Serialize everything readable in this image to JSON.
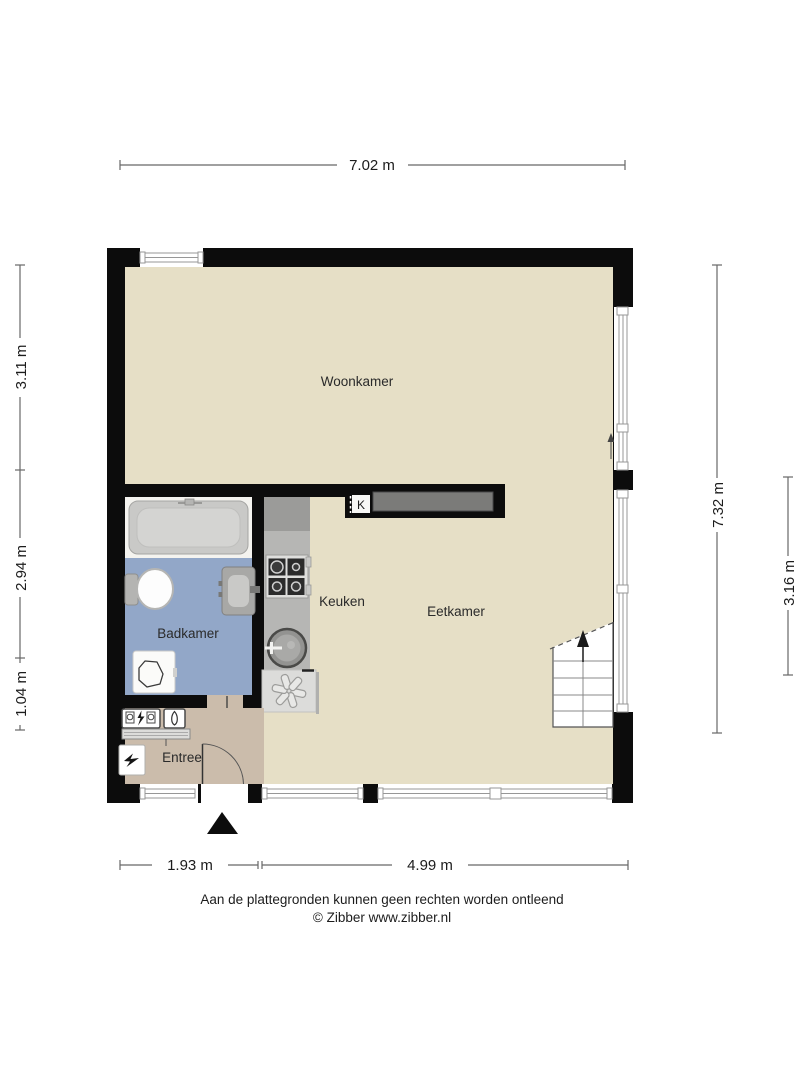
{
  "dimensions": {
    "top": "7.02 m",
    "left": [
      "3.11 m",
      "2.94 m",
      "1.04 m"
    ],
    "right": [
      "7.32 m",
      "3.16 m"
    ],
    "bottom": [
      "1.93 m",
      "4.99 m"
    ]
  },
  "rooms": {
    "woonkamer": "Woonkamer",
    "badkamer": "Badkamer",
    "keuken": "Keuken",
    "eetkamer": "Eetkamer",
    "entree": "Entree",
    "closet_marker": "K"
  },
  "footer": {
    "disclaimer": "Aan de plattegronden kunnen geen rechten worden ontleend",
    "copyright": "© Zibber www.zibber.nl"
  },
  "colors": {
    "background": "#ffffff",
    "wall": "#0c0c0c",
    "floor_main": "#e6dfc6",
    "floor_entree": "#cbbcab",
    "floor_badkamer": "#92a7c8",
    "counter_gray": "#b6b6b4",
    "counter_dark": "#9b9b99",
    "wall_counter_dark": "#7b7b79",
    "dimension_line": "#686868"
  },
  "icons": [
    "bathtub-icon",
    "toilet-icon",
    "washbasin-icon",
    "washing-machine-icon",
    "stove-icon",
    "kitchen-sink-icon",
    "boiler-vent-icon",
    "electric-meter-icon",
    "gas-meter-icon",
    "doorbell-icon",
    "stairs-icon",
    "stairs-up-arrow-icon",
    "window-icon",
    "door-swing-icon",
    "entrance-triangle-icon"
  ]
}
